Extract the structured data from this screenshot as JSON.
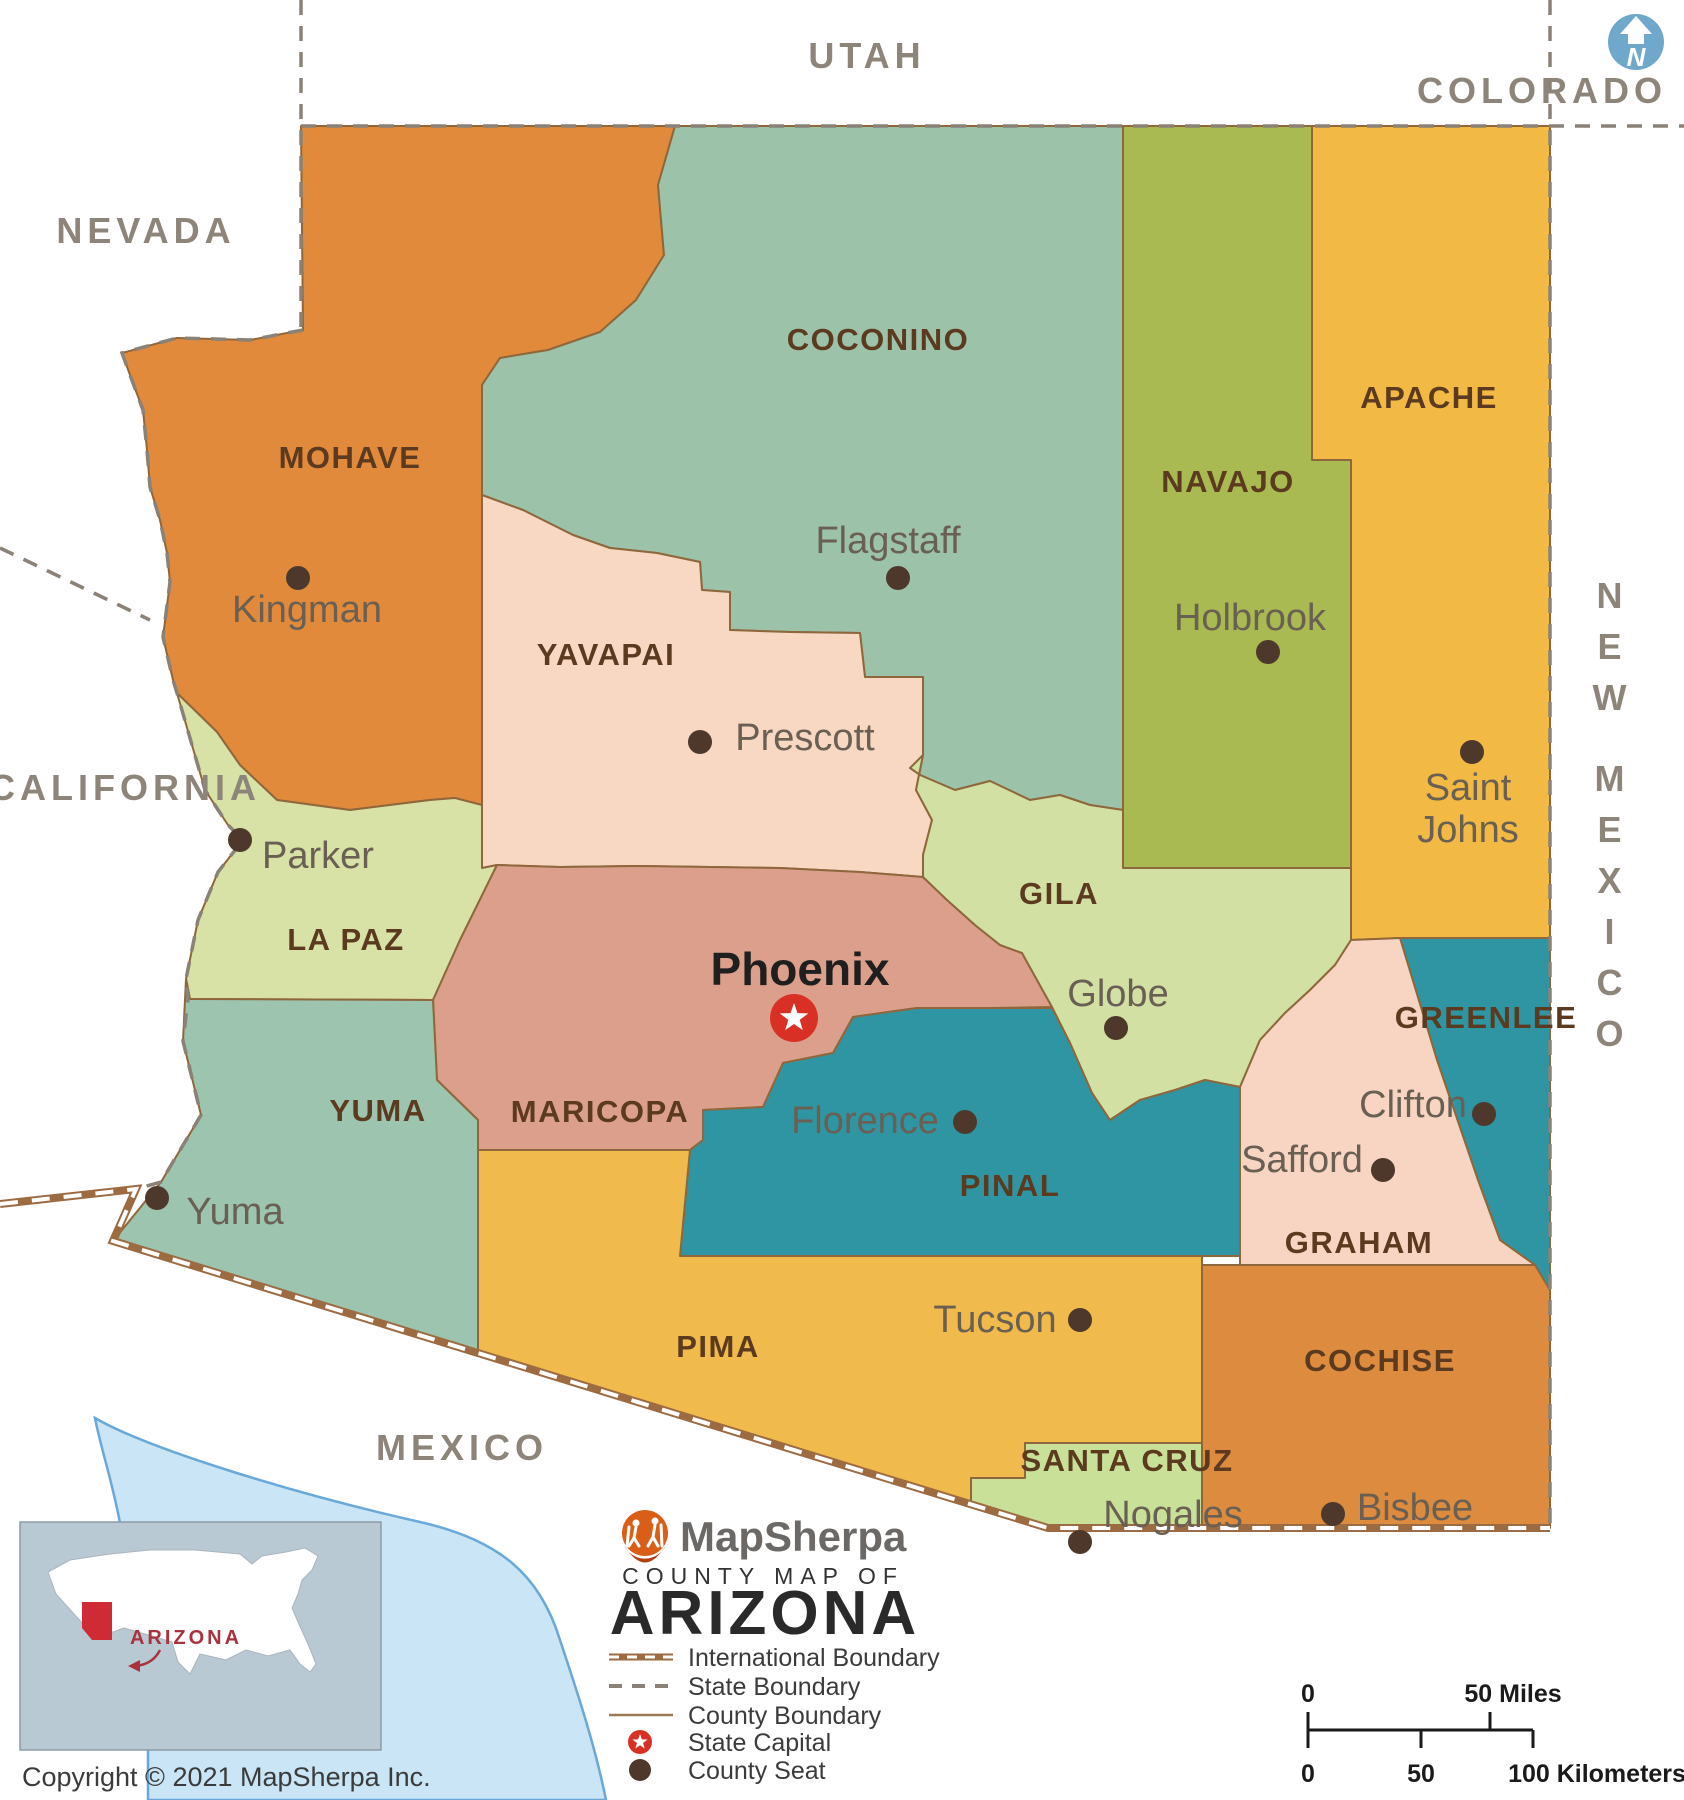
{
  "map": {
    "north_label": "N",
    "neighbors": [
      {
        "id": "utah",
        "label": "UTAH"
      },
      {
        "id": "nevada",
        "label": "NEVADA"
      },
      {
        "id": "colorado",
        "label": "COLORADO"
      },
      {
        "id": "california",
        "label": "CALIFORNIA"
      },
      {
        "id": "new-mexico",
        "label": "NEW MEXICO"
      },
      {
        "id": "mexico",
        "label": "MEXICO"
      }
    ],
    "counties": [
      {
        "id": "mohave",
        "name": "MOHAVE",
        "color": "#E28A3C",
        "seat": {
          "id": "kingman",
          "city": "Kingman"
        }
      },
      {
        "id": "coconino",
        "name": "COCONINO",
        "color": "#9CC2A9",
        "seat": {
          "id": "flagstaff",
          "city": "Flagstaff"
        }
      },
      {
        "id": "navajo",
        "name": "NAVAJO",
        "color": "#A8BA51",
        "seat": {
          "id": "holbrook",
          "city": "Holbrook"
        }
      },
      {
        "id": "apache",
        "name": "APACHE",
        "color": "#F2B944",
        "seat": {
          "id": "saint-johns",
          "city": "Saint Johns"
        }
      },
      {
        "id": "yavapai",
        "name": "YAVAPAI",
        "color": "#F8D8C3",
        "seat": {
          "id": "prescott",
          "city": "Prescott"
        }
      },
      {
        "id": "la-paz",
        "name": "LA PAZ",
        "color": "#D8E2A7",
        "seat": {
          "id": "parker",
          "city": "Parker"
        }
      },
      {
        "id": "maricopa",
        "name": "MARICOPA",
        "color": "#DB9F8C",
        "seat": {
          "id": "phoenix",
          "city": "Phoenix",
          "capital": true
        }
      },
      {
        "id": "gila",
        "name": "GILA",
        "color": "#D3E0A3",
        "seat": {
          "id": "globe",
          "city": "Globe"
        }
      },
      {
        "id": "pinal",
        "name": "PINAL",
        "color": "#2F95A3",
        "seat": {
          "id": "florence",
          "city": "Florence"
        }
      },
      {
        "id": "greenlee",
        "name": "GREENLEE",
        "color": "#2F95A3",
        "seat": {
          "id": "clifton",
          "city": "Clifton"
        }
      },
      {
        "id": "graham",
        "name": "GRAHAM",
        "color": "#F8D5C2",
        "seat": {
          "id": "safford",
          "city": "Safford"
        }
      },
      {
        "id": "yuma",
        "name": "YUMA",
        "color": "#9DC4AF",
        "seat": {
          "id": "yuma-city",
          "city": "Yuma"
        }
      },
      {
        "id": "pima",
        "name": "PIMA",
        "color": "#F1BA4C",
        "seat": {
          "id": "tucson",
          "city": "Tucson"
        }
      },
      {
        "id": "santa-cruz",
        "name": "SANTA CRUZ",
        "color": "#C9E099",
        "seat": {
          "id": "nogales",
          "city": "Nogales"
        }
      },
      {
        "id": "cochise",
        "name": "COCHISE",
        "color": "#DD8B3E",
        "seat": {
          "id": "bisbee",
          "city": "Bisbee"
        }
      }
    ],
    "boundary_colors": {
      "county": "#8F673C",
      "state": "#8A8177",
      "international": "#9C6B42",
      "water": "#C9E5F6",
      "coast": "#69A8D9"
    }
  },
  "legend": {
    "brand": "MapSherpa",
    "subtitle": "COUNTY MAP OF",
    "title": "ARIZONA",
    "items": [
      {
        "type": "international",
        "label": "International Boundary"
      },
      {
        "type": "state",
        "label": "State Boundary"
      },
      {
        "type": "county",
        "label": "County Boundary"
      },
      {
        "type": "capital",
        "label": "State Capital"
      },
      {
        "type": "seat",
        "label": "County Seat"
      }
    ]
  },
  "scalebar": {
    "miles_zero": "0",
    "miles_label": "50 Miles",
    "km_zero": "0",
    "km_mid": "50",
    "km_label": "100 Kilometers"
  },
  "inset": {
    "state_label": "ARIZONA"
  },
  "copyright": "Copyright © 2021 MapSherpa Inc.",
  "capital_color": "#D93025",
  "seat_color": "#4D382B"
}
